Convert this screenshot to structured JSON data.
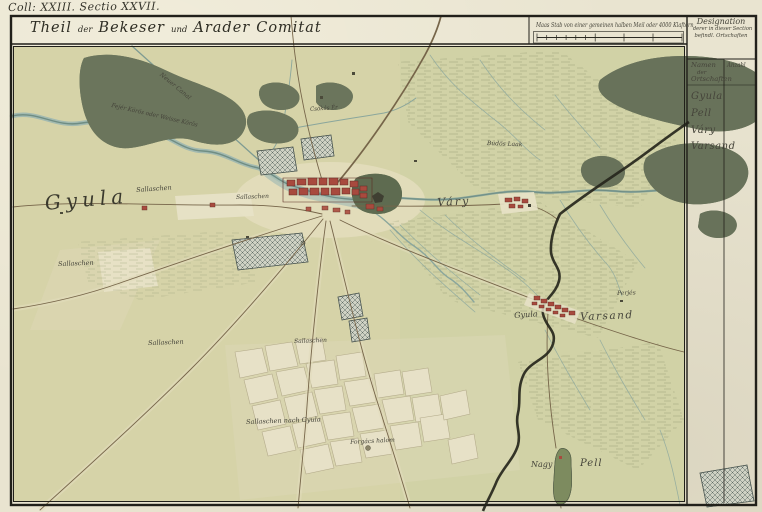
{
  "sheet": {
    "corner_label": "Coll: XXIII. Sectio XXVII.",
    "title_parts": [
      "Theil",
      "der",
      "Bekeser",
      "und",
      "Arader",
      "Comitat"
    ],
    "scale_caption": "Maas Stab von einer gemeinen halben Meil oder 4000 Klaftern"
  },
  "designation": {
    "heading_lines": [
      "Designation",
      "derer in dieser Section",
      "befindl. Ortschaften"
    ],
    "names_header_lines": [
      "Namen",
      "der",
      "Ortschaften"
    ],
    "count_header": "Anzahl",
    "places": [
      "Gyula",
      "Pell",
      "Váry",
      "Varsand"
    ]
  },
  "map_labels": {
    "town_gyula": "Gyula",
    "vary": "Váry",
    "varsand_prefix": "Gyula",
    "varsand": "Varsand",
    "nagy": "Nagy",
    "pell": "Pell",
    "river_white_koros": "Fejér Körös oder Weisse Körös",
    "neuer_canal": "Neuer Canal",
    "csokas_er": "Csókás Ér",
    "budos_laak": "Büdös Laak",
    "perjes": "Perjés",
    "sallaschen": "Sallaschen",
    "sallaschen_nach_gyula": "Sallaschen nach Gyula",
    "forgacs_halom": "Forgács halom"
  },
  "colors": {
    "paper": "#e9e4d0",
    "map_base": "#d6d3a8",
    "forest": "#6b755c",
    "river": "#7e9b90",
    "town_red": "#a84a3e",
    "boundary": "#26261c",
    "ink": "#35342b"
  }
}
